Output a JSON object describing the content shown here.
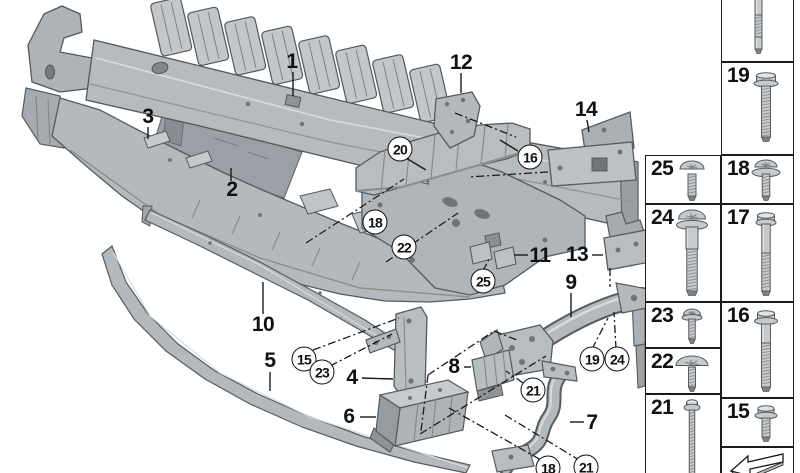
{
  "image": {
    "width": 800,
    "height": 473,
    "background": "#ffffff"
  },
  "colors": {
    "background": "#ffffff",
    "line": "#1a1a1a",
    "part_fill": "#b4b9bd",
    "part_light": "#d8dbdd",
    "part_dark": "#84898d",
    "part_outline": "#565b5f",
    "panel_fill": "#9aa0a5"
  },
  "diagram": {
    "callouts": [
      {
        "label": "1",
        "circled": false,
        "x": 292,
        "y": 62
      },
      {
        "label": "2",
        "circled": false,
        "x": 232,
        "y": 190
      },
      {
        "label": "3",
        "circled": false,
        "x": 148,
        "y": 117
      },
      {
        "label": "4",
        "circled": false,
        "x": 352,
        "y": 378
      },
      {
        "label": "5",
        "circled": false,
        "x": 270,
        "y": 361
      },
      {
        "label": "6",
        "circled": false,
        "x": 349,
        "y": 417
      },
      {
        "label": "7",
        "circled": false,
        "x": 592,
        "y": 423
      },
      {
        "label": "8",
        "circled": false,
        "x": 454,
        "y": 367
      },
      {
        "label": "9",
        "circled": false,
        "x": 571,
        "y": 283
      },
      {
        "label": "10",
        "circled": false,
        "x": 263,
        "y": 325
      },
      {
        "label": "11",
        "circled": false,
        "x": 540,
        "y": 256
      },
      {
        "label": "12",
        "circled": false,
        "x": 461,
        "y": 63
      },
      {
        "label": "13",
        "circled": false,
        "x": 577,
        "y": 255
      },
      {
        "label": "14",
        "circled": false,
        "x": 586,
        "y": 110
      },
      {
        "label": "15",
        "circled": true,
        "x": 304,
        "y": 359
      },
      {
        "label": "16",
        "circled": true,
        "x": 530,
        "y": 157
      },
      {
        "label": "18",
        "circled": true,
        "x": 375,
        "y": 222
      },
      {
        "label": "18",
        "circled": true,
        "x": 548,
        "y": 468
      },
      {
        "label": "19",
        "circled": true,
        "x": 592,
        "y": 359
      },
      {
        "label": "20",
        "circled": true,
        "x": 400,
        "y": 149
      },
      {
        "label": "21",
        "circled": true,
        "x": 533,
        "y": 390
      },
      {
        "label": "21",
        "circled": true,
        "x": 586,
        "y": 467
      },
      {
        "label": "22",
        "circled": true,
        "x": 404,
        "y": 247
      },
      {
        "label": "23",
        "circled": true,
        "x": 322,
        "y": 372
      },
      {
        "label": "24",
        "circled": true,
        "x": 617,
        "y": 359
      },
      {
        "label": "25",
        "circled": true,
        "x": 483,
        "y": 281
      }
    ]
  },
  "sidebar": {
    "cells": [
      {
        "number": "",
        "icon": "threaded-stud-icon",
        "x": 721,
        "y": -2,
        "w": 73,
        "h": 64
      },
      {
        "number": "19",
        "icon": "hex-flange-bolt-icon",
        "x": 721,
        "y": 62,
        "w": 73,
        "h": 93
      },
      {
        "number": "25",
        "icon": "pan-head-torx-screw-icon",
        "x": 645,
        "y": 155,
        "w": 76,
        "h": 49
      },
      {
        "number": "18",
        "icon": "torx-screw-washer-icon",
        "x": 721,
        "y": 155,
        "w": 73,
        "h": 49
      },
      {
        "number": "24",
        "icon": "shoulder-torx-screw-icon",
        "x": 645,
        "y": 204,
        "w": 76,
        "h": 98
      },
      {
        "number": "17",
        "icon": "hex-bolt-long-icon",
        "x": 721,
        "y": 204,
        "w": 73,
        "h": 98
      },
      {
        "number": "23",
        "icon": "torx-flange-screw-icon",
        "x": 645,
        "y": 302,
        "w": 76,
        "h": 46
      },
      {
        "number": "16",
        "icon": "hex-flange-bolt-long-icon",
        "x": 721,
        "y": 302,
        "w": 73,
        "h": 96
      },
      {
        "number": "22",
        "icon": "mushroom-head-screw-icon",
        "x": 645,
        "y": 348,
        "w": 76,
        "h": 46
      },
      {
        "number": "21",
        "icon": "thin-screw-long-icon",
        "x": 645,
        "y": 394,
        "w": 76,
        "h": 82
      },
      {
        "number": "15",
        "icon": "hex-flange-screw-short-icon",
        "x": 721,
        "y": 398,
        "w": 73,
        "h": 49
      },
      {
        "number": "",
        "icon": "direction-arrow-icon",
        "x": 721,
        "y": 447,
        "w": 73,
        "h": 29
      }
    ]
  }
}
